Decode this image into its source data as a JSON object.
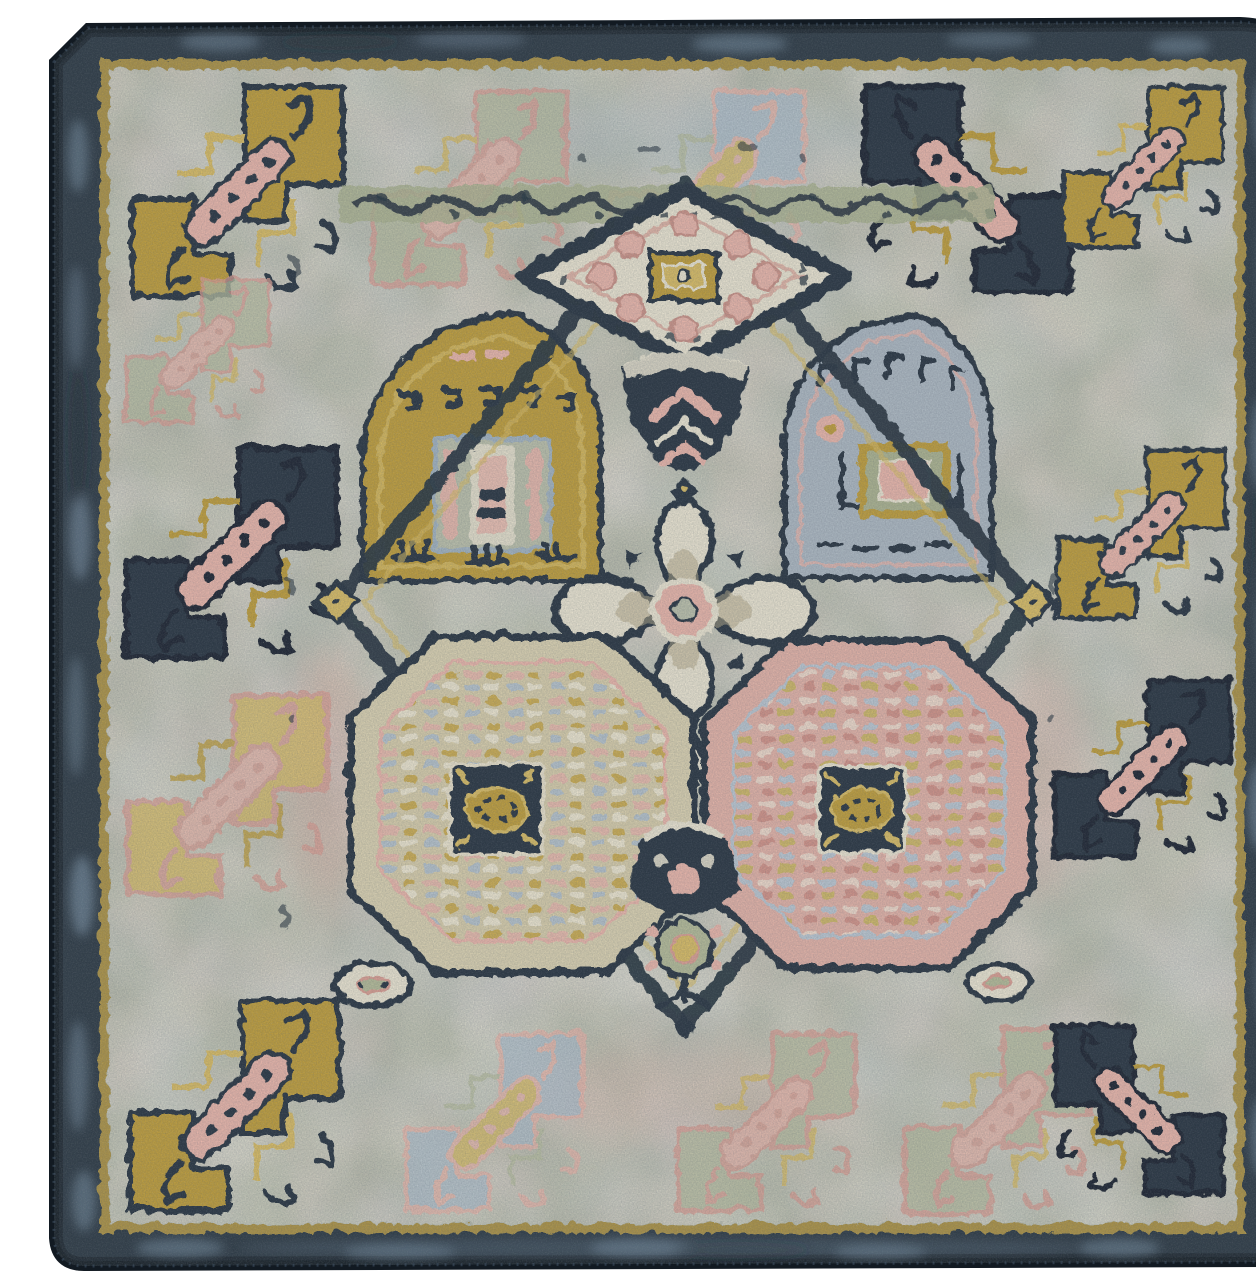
{
  "image": {
    "kind": "product photo",
    "subject": "Square vintage tribal-style area rug, overhead view",
    "aria_label": "Overhead photo of a square vintage-style area rug with a mottled dark navy border, thin gold trim line, light gray-green field, stepped hook corner motifs in gold, pink and navy, and a central geometric diamond composition containing a rosette diamond, a gold panel, a blue panel, an ivory quatrefoil flower, a gold octagonal medallion and a pink octagonal medallion, each with dark navy centers holding a gold oval."
  },
  "regions": [
    "navy outer border band",
    "gold trim line",
    "gray-sage field with faded mottling",
    "stepped hook gul motifs around the perimeter",
    "scroll vine band above center panel",
    "top diamond rosette medallion",
    "gold ornament panel",
    "blue ornament panel",
    "central ivory quatrefoil",
    "gold octagon medallion with navy center",
    "pink octagon medallion with navy center",
    "bottom navy pendant and floral cluster"
  ],
  "palette": {
    "photo_bg": "#ffffff",
    "edge_dark": "#121a22",
    "border_navy": "#28343f",
    "border_mottle": "#7e96ab",
    "border_mottle_dark": "#17202a",
    "gold_stripe": "#ab9040",
    "field_base": "#b7b9aa",
    "field_sage": "#aeb493",
    "field_pink": "#e3b4a9",
    "field_blue": "#a7b9c7",
    "field_cream": "#dcd4bd",
    "navy": "#222e3a",
    "navy_deep": "#161f29",
    "gold": "#bd9a35",
    "gold_light": "#d7b95e",
    "pink": "#e9b3a7",
    "pink_deep": "#d99b8f",
    "ivory": "#eae3cf",
    "tan": "#b2a585",
    "sage": "#a9b08c"
  }
}
